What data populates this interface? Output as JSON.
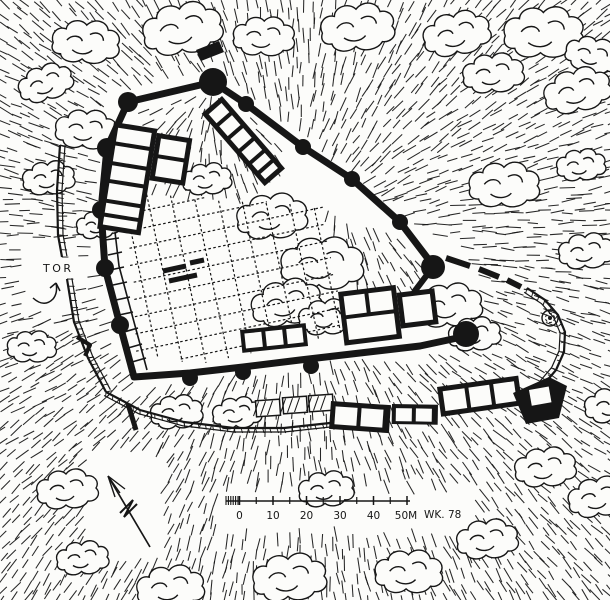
{
  "map": {
    "kind": "hand-drawn castle ground plan",
    "ink_color": "#161616",
    "paper_color": "#fcfcfa",
    "labels": {
      "gate": "TOR",
      "scale_end": "50M",
      "signature": "WK. 78"
    },
    "scale_bar": {
      "tick_labels": [
        "0",
        "10",
        "20",
        "30",
        "40"
      ]
    },
    "icons": {
      "north_arrow": "north-arrow-icon",
      "gate_arrow": "curved-gate-arrow-icon"
    }
  }
}
